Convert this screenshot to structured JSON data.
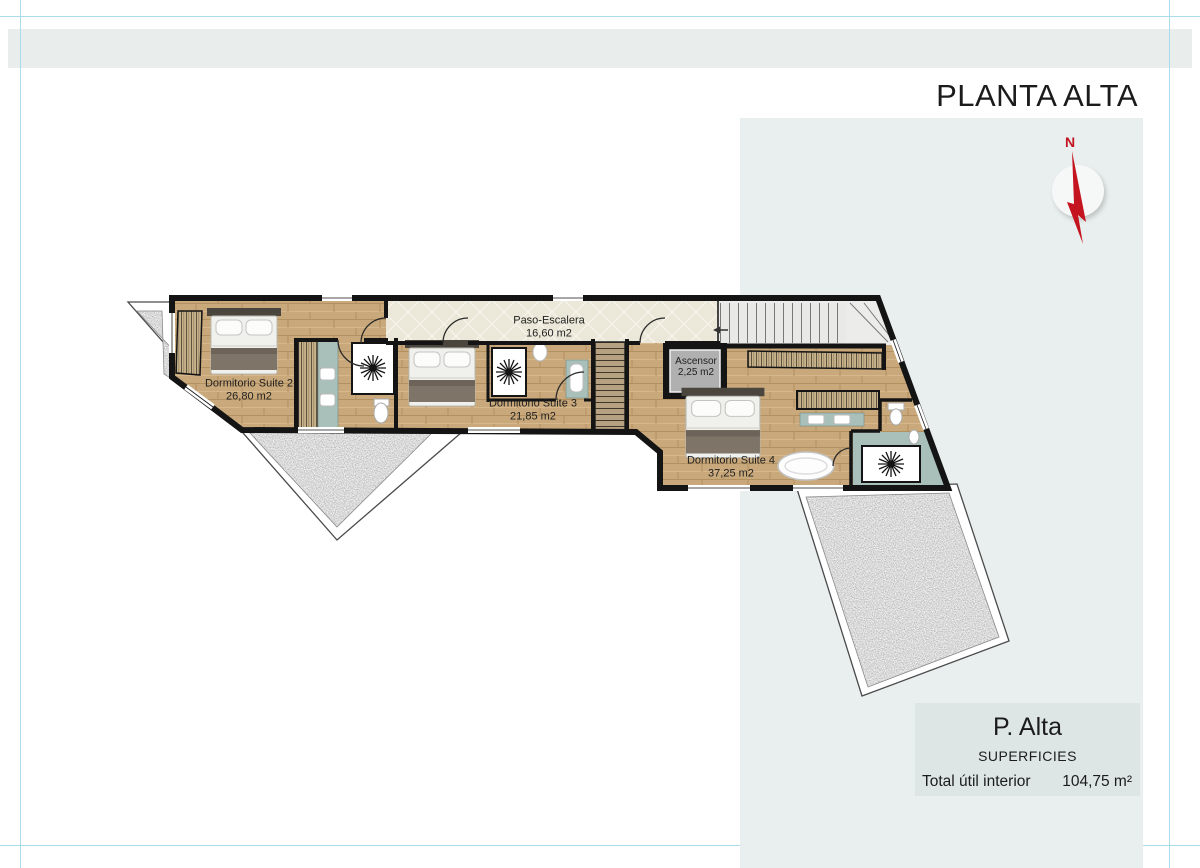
{
  "header": {
    "title": "PLANTA ALTA"
  },
  "compass": {
    "north_label": "N"
  },
  "plan": {
    "rooms": [
      {
        "name": "Paso-Escalera",
        "area": "16,60 m2"
      },
      {
        "name": "Dormitorio Suite 2",
        "area": "26,80 m2"
      },
      {
        "name": "Dormitorio Suite 3",
        "area": "21,85 m2"
      },
      {
        "name": "Dormitorio Suite 4",
        "area": "37,25 m2"
      },
      {
        "name": "Ascensor",
        "area": "2,25 m2"
      }
    ]
  },
  "legend": {
    "title": "P. Alta",
    "subtitle": "SUPERFICIES",
    "total_label": "Total útil interior",
    "total_value": "104,75 m²"
  },
  "colors": {
    "accent_red": "#c41420",
    "panel_gray": "#e9efee",
    "wood_floor": "#c9a97b",
    "bath_teal": "#a9c0ba",
    "guide_cyan": "#abdce9",
    "wall_black": "#141414"
  }
}
